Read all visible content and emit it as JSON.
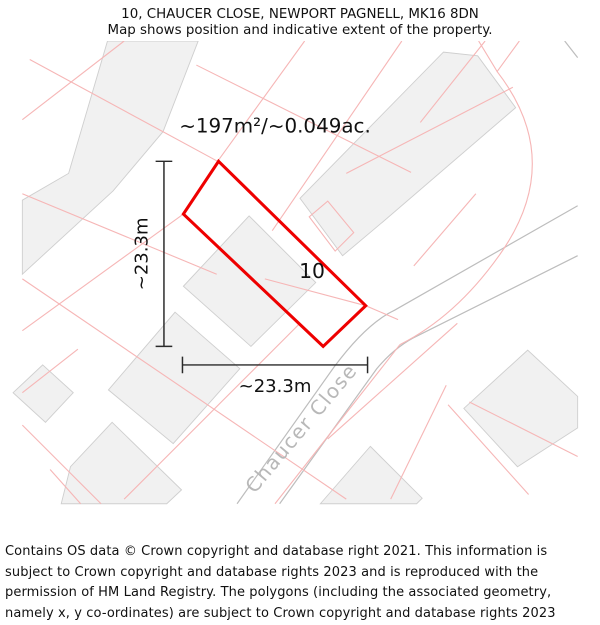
{
  "header": {
    "title": "10, CHAUCER CLOSE, NEWPORT PAGNELL, MK16 8DN",
    "subtitle": "Map shows position and indicative extent of the property."
  },
  "map": {
    "area_label": "~197m²/~0.049ac.",
    "plot_number": "10",
    "width_label": "~23.3m",
    "height_label": "~23.3m",
    "street_label": "Chaucer Close",
    "colors": {
      "property_outline": "#ee0000",
      "parcel_line": "#f6b6b6",
      "building_fill": "#f1f1f1",
      "building_stroke": "#cfcfcf",
      "road_line": "#bdbdbd",
      "dimension": "#2a2a2a",
      "street_label": "#b8b8b8"
    }
  },
  "footer": {
    "copyright": "Contains OS data © Crown copyright and database right 2021. This information is subject to Crown copyright and database rights 2023 and is reproduced with the permission of HM Land Registry. The polygons (including the associated geometry, namely x, y co-ordinates) are subject to Crown copyright and database rights 2023 Ordnance Survey 100026316."
  }
}
